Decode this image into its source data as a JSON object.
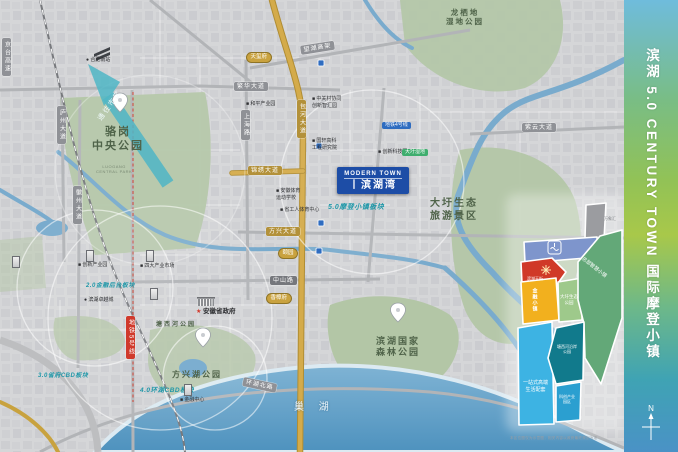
{
  "sidebar": {
    "title": "滨湖 5.0 CENTURY TOWN 国际摩登小镇",
    "compass_n": "N"
  },
  "project": {
    "name_en": "MODERN TOWN",
    "name_cn": "丨滨湖湾"
  },
  "arrow": {
    "label": "通往市区"
  },
  "lake": {
    "label": "巢 湖"
  },
  "roads": {
    "fanhua": "繁华大道",
    "ziyun": "紫云大道",
    "wanghu": "望湖高架",
    "jinxiu": "锦绣大道",
    "fangxing": "方兴大道",
    "zhongshan": "中山路",
    "huanhubei": "环湖北路",
    "luzhou": "庐州大道",
    "huizhou": "徽州大道",
    "shanghai": "上海路",
    "baohe": "包河大道",
    "jingtai": "京台高速",
    "metro5": "地铁5号线"
  },
  "parks": {
    "luogang": "骆岗\n中央公园",
    "luogang_en": "LUOGANG\nCENTRAL PARK",
    "longqidi": "龙栖地\n湿地公园",
    "dawei": "大圩生态\n旅游景区",
    "forest": "滨湖国家\n森林公园",
    "fangxinghu": "方兴湖公园",
    "tangxihe": "塘西河公园"
  },
  "pois": {
    "south_station": "● 合肥南站",
    "heping": "■ 和平产业园",
    "zgc": "■ 中关村协同\n创新智汇园",
    "guoxuan": "■ 国轩高科\n工程研究院",
    "tech": "■ 创新科技园",
    "sports_school": "■ 安徽体育\n运动学校",
    "workers": "■ 省工人体育中心",
    "zhuoyue": "● 滨湖卓越城",
    "market": "■ 四大产业市场",
    "industry": "■ 创新产业园",
    "gov": "安徽省政府",
    "finance": "■ 金融中心"
  },
  "sectors": {
    "s50": "5.0摩登小镇板块",
    "s20": "2.0金融后台板块",
    "s30": "3.0省府CBD板块",
    "s40": "4.0环湖CBD板块"
  },
  "transit": {
    "metro_badge": "地铁4号线",
    "tram_badge": "大圩湿地"
  },
  "badges": {
    "tianxifu": "天玺府",
    "yiyuan": "颐园",
    "xiangzhangfu": "香樟府"
  },
  "inset": {
    "wanxianghui": "万象汇",
    "tianjie": "滨湖天街",
    "jinrong": "金融小镇",
    "dawei_park": "大圩生态\n公园",
    "hq_town": "总部智慧小镇",
    "life": "一站式高端\n生活配套",
    "tangxihe": "塘西河沿岸\n公园",
    "kechuang": "科创产业\n园区",
    "note": "本区位图仅为示意图，相关内容以政府最终规划为准"
  },
  "colors": {
    "accent_blue": "#1d4da6",
    "gold_road": "#c8a23e",
    "metro_red": "#d03a2c",
    "water": "#79abcd",
    "park_green": "#b3c6a6",
    "sector_teal": "#1f97a8"
  }
}
